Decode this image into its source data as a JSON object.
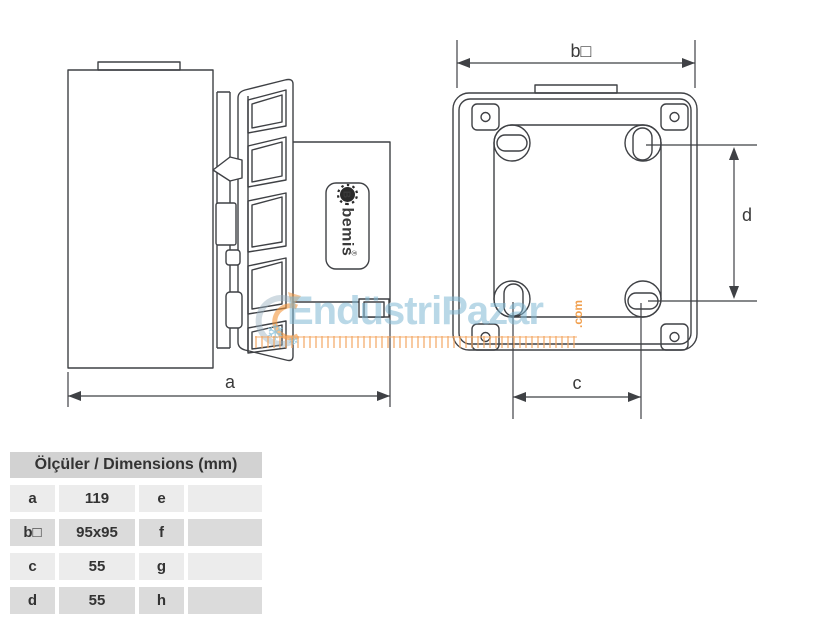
{
  "canvas": {
    "width": 825,
    "height": 625,
    "background": "#FFFFFF"
  },
  "colors": {
    "line": "#3F4145",
    "text": "#333333",
    "watermark_blue": "#7FB8D4",
    "watermark_orange": "#F3A662",
    "table_header_bg": "#D2D2D2",
    "table_row_light": "#ECECEC",
    "table_row_dark": "#DBDBDB"
  },
  "drawing": {
    "brand_plate": {
      "icon_letter": "B",
      "name": "bemis",
      "registered": "®"
    },
    "dimension_labels": {
      "a": "a",
      "b": "b□",
      "c": "c",
      "d": "d"
    }
  },
  "watermark": {
    "text": "EndüstriPazar",
    "suffix": ".com",
    "snowflake_large": "❄",
    "snowflake_small": "❄"
  },
  "table": {
    "header": "Ölçüler / Dimensions (mm)",
    "rows": [
      {
        "label": "a",
        "value": "119",
        "label2": "e",
        "value2": ""
      },
      {
        "label": "b□",
        "value": "95x95",
        "label2": "f",
        "value2": ""
      },
      {
        "label": "c",
        "value": "55",
        "label2": "g",
        "value2": ""
      },
      {
        "label": "d",
        "value": "55",
        "label2": "h",
        "value2": ""
      }
    ]
  }
}
